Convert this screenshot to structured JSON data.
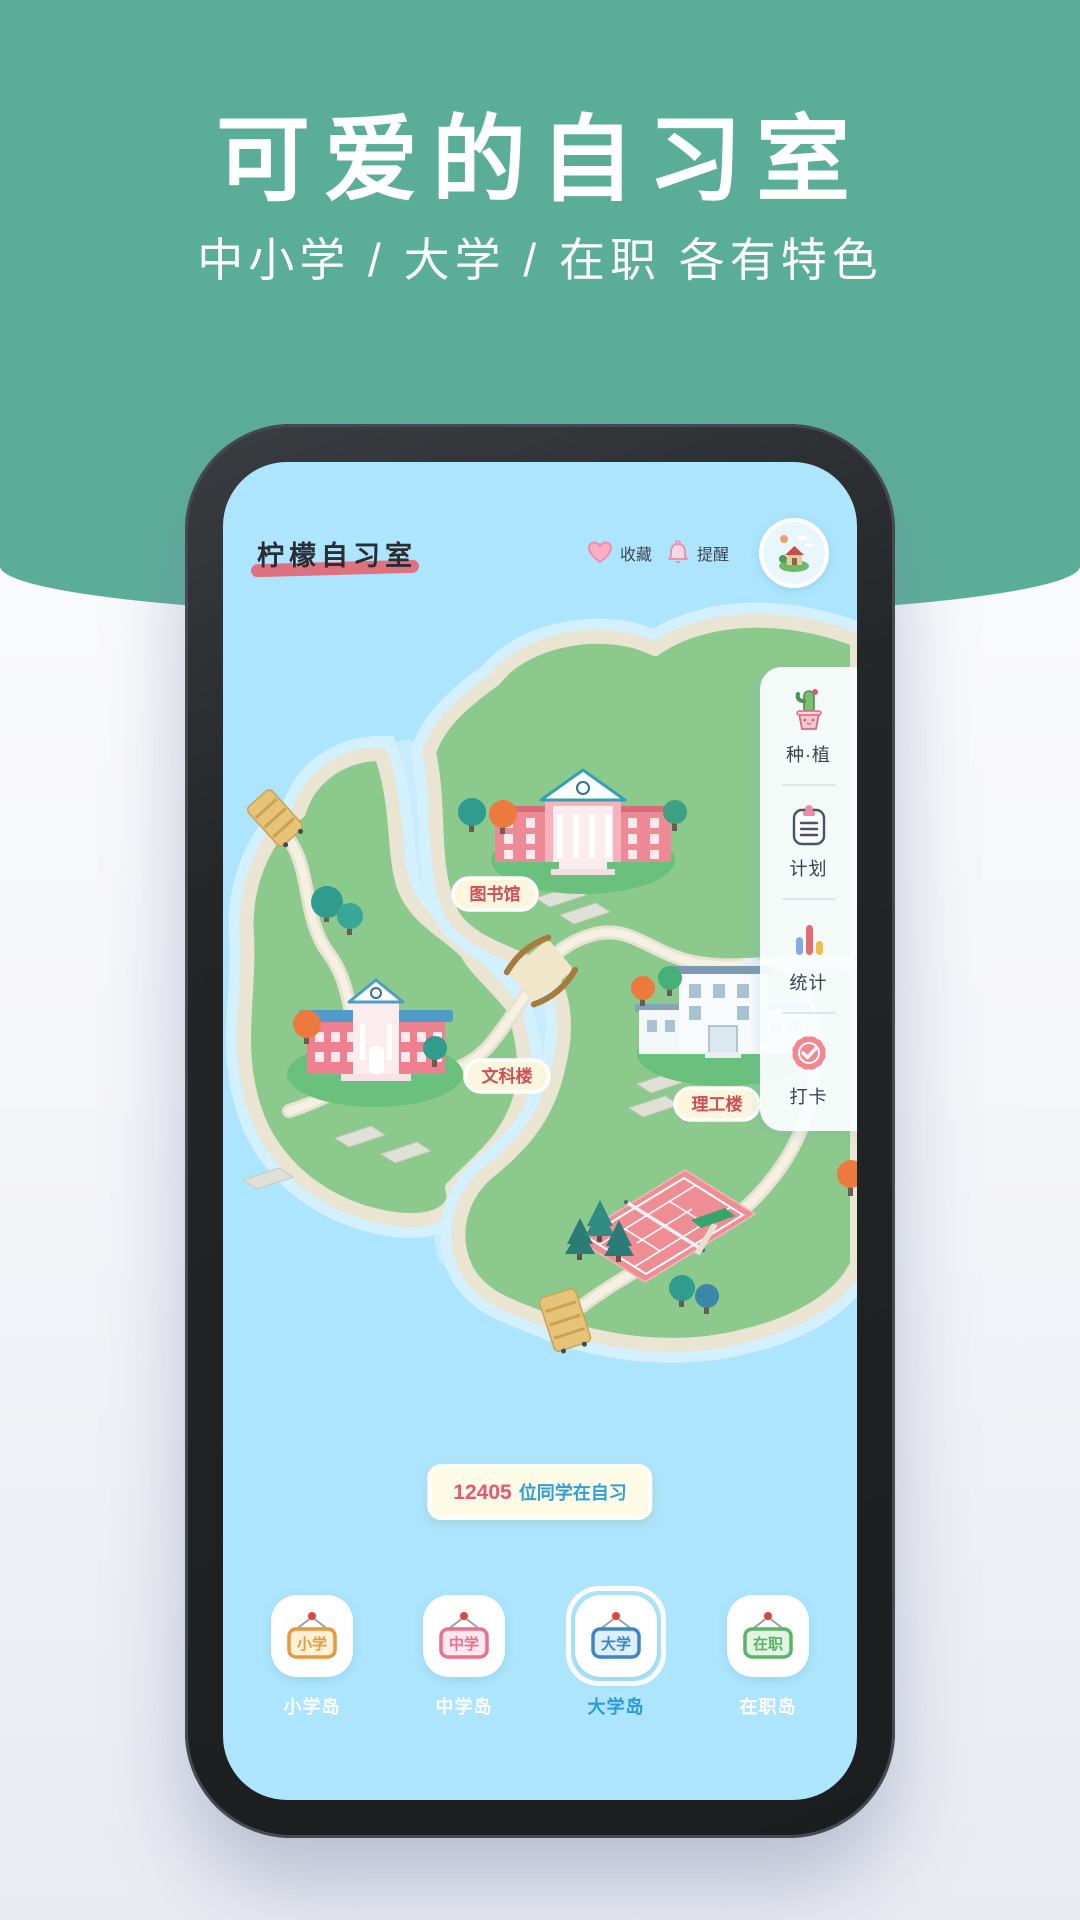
{
  "hero": {
    "title": "可爱的自习室",
    "subtitle": "中小学 / 大学 / 在职 各有特色"
  },
  "header": {
    "logo": "柠檬自习室",
    "favorite_label": "收藏",
    "favorite_icon": "heart-icon",
    "reminder_label": "提醒",
    "reminder_icon": "bell-icon",
    "avatar_icon": "house-island-avatar"
  },
  "sidebar": {
    "items": [
      {
        "icon": "cactus-plant-icon",
        "label": "种·植"
      },
      {
        "icon": "clipboard-plan-icon",
        "label": "计划"
      },
      {
        "icon": "bar-chart-icon",
        "label": "统计"
      },
      {
        "icon": "check-badge-icon",
        "label": "打卡"
      }
    ]
  },
  "map": {
    "labels": {
      "library": "图书馆",
      "liberal_arts": "文科楼",
      "science": "理工楼"
    }
  },
  "banner": {
    "count": "12405",
    "text": "位同学在自习"
  },
  "tabs": [
    {
      "sign": "小学",
      "label": "小学岛",
      "selected": false,
      "color": "#e8973c",
      "bg": "#fdf2d8"
    },
    {
      "sign": "中学",
      "label": "中学岛",
      "selected": false,
      "color": "#ee6e8d",
      "bg": "#fde9ef"
    },
    {
      "sign": "大学",
      "label": "大学岛",
      "selected": true,
      "color": "#3c86c6",
      "bg": "#ddeffb"
    },
    {
      "sign": "在职",
      "label": "在职岛",
      "selected": false,
      "color": "#58b568",
      "bg": "#e3f4e4"
    }
  ],
  "colors": {
    "hero_green": "#5aae97",
    "screen_blue": "#ace5fd",
    "island_green": "#8cc98d",
    "mound_green": "#6ac17e",
    "sand": "#eae4d3",
    "label_red": "#cf4f55",
    "banner_count_pink": "#e75672",
    "banner_text_blue": "#2f9fd8",
    "selected_tab_blue": "#2b9bd8"
  }
}
